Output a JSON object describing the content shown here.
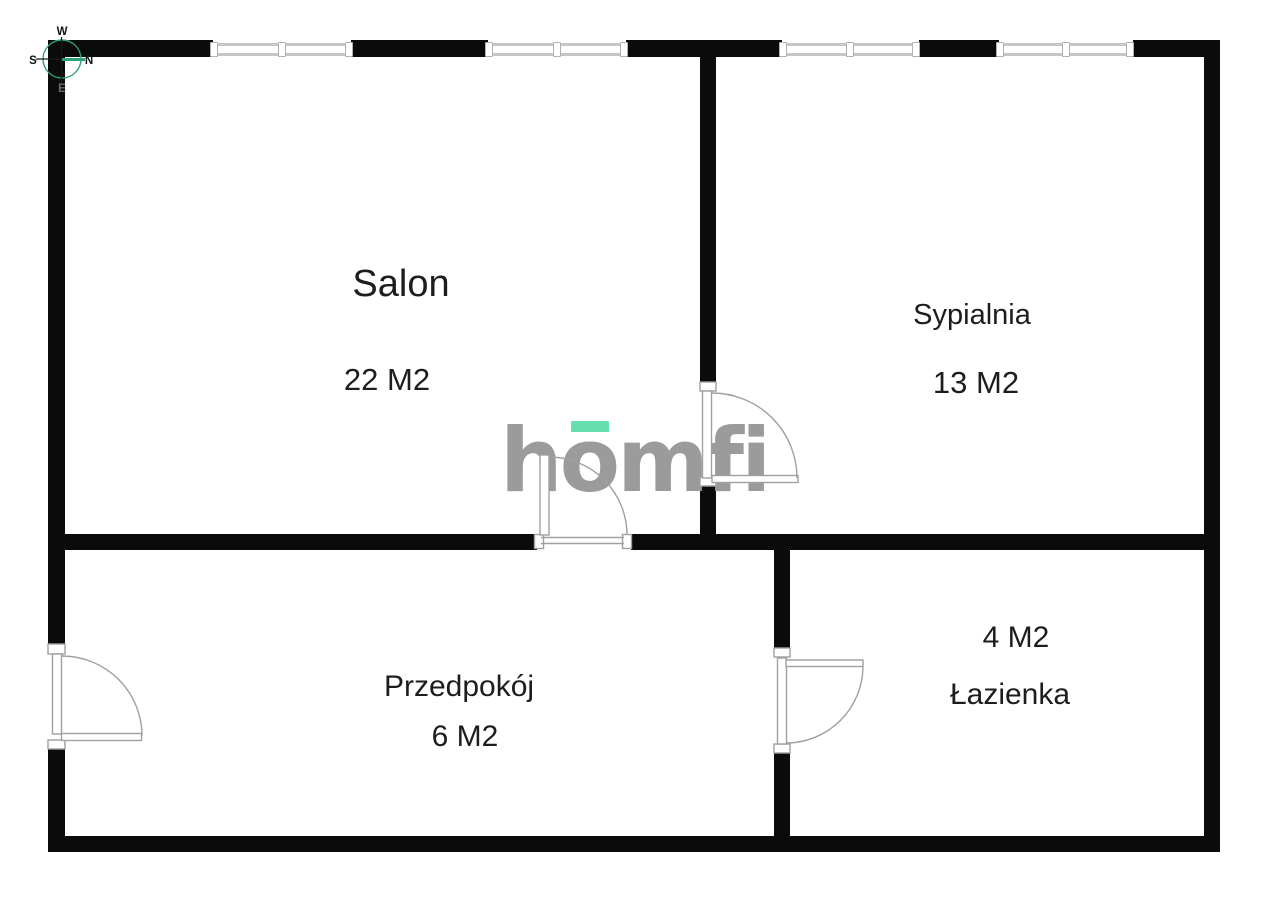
{
  "rooms": [
    {
      "name": "Salon",
      "area": "22 M2"
    },
    {
      "name": "Sypialnia",
      "area": "13 M2"
    },
    {
      "name": "Przedpokój",
      "area": "6 M2"
    },
    {
      "name": "Łazienka",
      "area": "4 M2"
    }
  ],
  "compass": {
    "west": "W",
    "south": "S",
    "north": "N",
    "east": "E"
  },
  "watermark": {
    "text": "homfi"
  },
  "colors": {
    "wall": "#0b0b0b",
    "door_line": "#a0a0a0",
    "window_line": "#c6c6c6",
    "compass_green": "#2f9f78",
    "logo_gray": "#9b9b9b",
    "logo_accent": "#64dfad",
    "label_text": "#1d1d1d",
    "background": "#ffffff"
  }
}
